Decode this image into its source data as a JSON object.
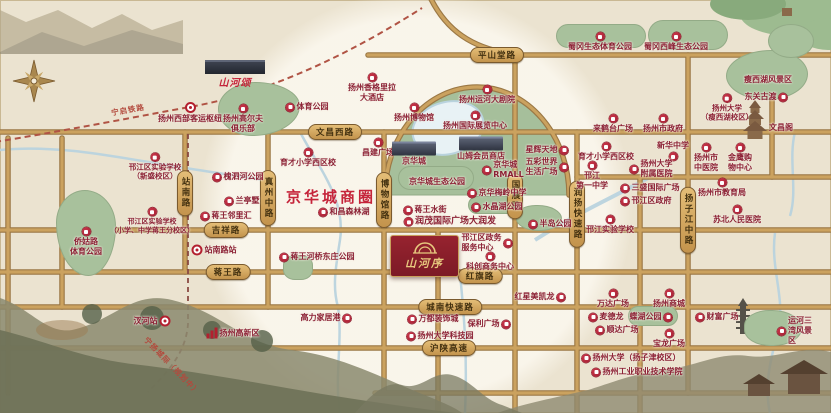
{
  "map": {
    "business_circle": "京华城商圈",
    "project": {
      "name": "山河序",
      "sister_project": "山河颂"
    },
    "colors": {
      "bg": "#ebe3d0",
      "road_fill": "#cba25f",
      "road_edge": "#9b7845",
      "park_green": "#a8c19c",
      "water_blue": "#b9d3de",
      "poi_red": "#9c1e31",
      "poi_text": "#8c2135",
      "pill_gold": "#d4a95f",
      "pill_text": "#42300f",
      "project_red": "#8e1f2f",
      "project_gold": "#e7c87e",
      "accent_red": "#c5243a"
    },
    "road_labels_h": [
      {
        "text": "平山堂路",
        "x": 497,
        "y": 55
      },
      {
        "text": "文昌西路",
        "x": 335,
        "y": 132
      },
      {
        "text": "吉祥路",
        "x": 226,
        "y": 230
      },
      {
        "text": "蒋王路",
        "x": 228,
        "y": 272
      },
      {
        "text": "红旗路",
        "x": 480,
        "y": 276
      },
      {
        "text": "城南快速路",
        "x": 450,
        "y": 307
      },
      {
        "text": "沪陕高速",
        "x": 449,
        "y": 348
      }
    ],
    "road_labels_v": [
      {
        "text": "站南路",
        "x": 185,
        "y": 193
      },
      {
        "text": "真州中路",
        "x": 268,
        "y": 198
      },
      {
        "text": "博物馆路",
        "x": 384,
        "y": 200
      },
      {
        "text": "国展路",
        "x": 515,
        "y": 196
      },
      {
        "text": "润扬快速路",
        "x": 577,
        "y": 214
      },
      {
        "text": "扬子江中路",
        "x": 688,
        "y": 220
      }
    ],
    "rail_labels": [
      {
        "text": "宁启铁路",
        "x": 128,
        "y": 110,
        "angle": -10
      },
      {
        "text": "宁扬城际（规划中）",
        "x": 172,
        "y": 366,
        "angle": 46
      }
    ],
    "pois": [
      {
        "t": "扬州西部客运枢纽",
        "x": 190,
        "y": 113,
        "lay": "col",
        "icon": "station"
      },
      {
        "t": "扬州高尔夫\n俱乐部",
        "x": 243,
        "y": 119,
        "lay": "col",
        "icon": "badge"
      },
      {
        "t": "体育公园",
        "x": 307,
        "y": 107,
        "lay": "row",
        "icon": "badge"
      },
      {
        "t": "扬州香格里拉\n大酒店",
        "x": 372,
        "y": 88,
        "lay": "col",
        "icon": "badge"
      },
      {
        "t": "育才小学西区校",
        "x": 308,
        "y": 158,
        "lay": "col",
        "icon": "badge"
      },
      {
        "t": "昌建广场",
        "x": 378,
        "y": 148,
        "lay": "col",
        "icon": "badge"
      },
      {
        "t": "扬州博物馆",
        "x": 414,
        "y": 113,
        "lay": "col",
        "icon": "badge"
      },
      {
        "t": "扬州运河大剧院",
        "x": 487,
        "y": 95,
        "lay": "col",
        "icon": "badge"
      },
      {
        "t": "扬州国际展览中心",
        "x": 475,
        "y": 121,
        "lay": "col",
        "icon": "badge"
      },
      {
        "t": "蜀冈生态体育公园",
        "x": 600,
        "y": 42,
        "lay": "col",
        "icon": "badge"
      },
      {
        "t": "蜀冈西峰生态公园",
        "x": 676,
        "y": 42,
        "lay": "col",
        "icon": "badge"
      },
      {
        "t": "瘦西湖风景区",
        "x": 768,
        "y": 80,
        "lay": "txt",
        "icon": "none"
      },
      {
        "t": "扬州大学\n（瘦西湖校区）",
        "x": 727,
        "y": 108,
        "lay": "col",
        "icon": "badge",
        "fs": 7.5
      },
      {
        "t": "东关古渡",
        "x": 766,
        "y": 97,
        "lay": "rowr",
        "icon": "badge"
      },
      {
        "t": "文昌阁",
        "x": 781,
        "y": 128,
        "lay": "txt",
        "icon": "none"
      },
      {
        "t": "来鹤台广场",
        "x": 613,
        "y": 124,
        "lay": "col",
        "icon": "badge"
      },
      {
        "t": "扬州市政府",
        "x": 663,
        "y": 124,
        "lay": "col",
        "icon": "badge"
      },
      {
        "t": "新华中学",
        "x": 673,
        "y": 151,
        "lay": "colr",
        "icon": "badge"
      },
      {
        "t": "扬州市\n中医院",
        "x": 706,
        "y": 158,
        "lay": "col",
        "icon": "badge"
      },
      {
        "t": "金鹰购\n物中心",
        "x": 740,
        "y": 158,
        "lay": "col",
        "icon": "badge"
      },
      {
        "t": "扬州市教育局",
        "x": 722,
        "y": 188,
        "lay": "col",
        "icon": "badge"
      },
      {
        "t": "苏北人民医院",
        "x": 737,
        "y": 215,
        "lay": "col",
        "icon": "badge"
      },
      {
        "t": "扬州大学\n附属医院",
        "x": 651,
        "y": 169,
        "lay": "row",
        "icon": "badge"
      },
      {
        "t": "三盛国际广场",
        "x": 650,
        "y": 188,
        "lay": "row",
        "icon": "badge"
      },
      {
        "t": "邗江区政府",
        "x": 646,
        "y": 201,
        "lay": "row",
        "icon": "badge"
      },
      {
        "t": "邗江\n第一中学",
        "x": 592,
        "y": 176,
        "lay": "col",
        "icon": "badge"
      },
      {
        "t": "半岛公园",
        "x": 550,
        "y": 224,
        "lay": "row",
        "icon": "badge"
      },
      {
        "t": "邗江实验学校",
        "x": 610,
        "y": 225,
        "lay": "col",
        "icon": "badge"
      },
      {
        "t": "邗江区实验学校\n（新盛校区）",
        "x": 155,
        "y": 167,
        "lay": "col",
        "icon": "badge",
        "fs": 7.5
      },
      {
        "t": "槐泗河公园",
        "x": 238,
        "y": 177,
        "lay": "row",
        "icon": "badge"
      },
      {
        "t": "兰亭墅",
        "x": 242,
        "y": 201,
        "lay": "row",
        "icon": "badge"
      },
      {
        "t": "蒋王邻里汇",
        "x": 226,
        "y": 216,
        "lay": "row",
        "icon": "badge"
      },
      {
        "t": "邗江区实验学校\n（小学、中学蒋王分校区）",
        "x": 152,
        "y": 221,
        "lay": "col",
        "icon": "badge",
        "fs": 7
      },
      {
        "t": "侨姑路\n体育公园",
        "x": 86,
        "y": 242,
        "lay": "col",
        "icon": "badge"
      },
      {
        "t": "站南路站",
        "x": 214,
        "y": 250,
        "lay": "row",
        "icon": "station"
      },
      {
        "t": "京华城",
        "x": 414,
        "y": 154,
        "lay": "col",
        "icon": "bldg"
      },
      {
        "t": "山姆会员商店",
        "x": 481,
        "y": 149,
        "lay": "col",
        "icon": "bldg"
      },
      {
        "t": "京华城\nRMALL",
        "x": 503,
        "y": 170,
        "lay": "row",
        "icon": "badge"
      },
      {
        "t": "京华城生态公园",
        "x": 437,
        "y": 182,
        "lay": "txt",
        "icon": "none"
      },
      {
        "t": "京华梅岭中学",
        "x": 497,
        "y": 193,
        "lay": "row",
        "icon": "badge"
      },
      {
        "t": "水晶湖公园",
        "x": 497,
        "y": 207,
        "lay": "row",
        "icon": "badge"
      },
      {
        "t": "蒋王水街",
        "x": 425,
        "y": 210,
        "lay": "row",
        "icon": "badge"
      },
      {
        "t": "润茂国际广场大润发",
        "x": 450,
        "y": 222,
        "lay": "row",
        "icon": "badge",
        "fs": 9
      },
      {
        "t": "和昌森林湖",
        "x": 344,
        "y": 212,
        "lay": "row",
        "icon": "badge"
      },
      {
        "t": "星辉天地",
        "x": 547,
        "y": 150,
        "lay": "rowr",
        "icon": "badge"
      },
      {
        "t": "五彩世界\n生活广场",
        "x": 547,
        "y": 167,
        "lay": "rowr",
        "icon": "badge"
      },
      {
        "t": "育才小学西区校",
        "x": 606,
        "y": 152,
        "lay": "col",
        "icon": "badge"
      },
      {
        "t": "蒋王河桥东庄公园",
        "x": 317,
        "y": 257,
        "lay": "row",
        "icon": "badge"
      },
      {
        "t": "邗江区政务\n服务中心",
        "x": 487,
        "y": 243,
        "lay": "rowr",
        "icon": "badge"
      },
      {
        "t": "科创商务中心",
        "x": 490,
        "y": 262,
        "lay": "col",
        "icon": "badge"
      },
      {
        "t": "红星美凯龙",
        "x": 540,
        "y": 297,
        "lay": "rowr",
        "icon": "badge"
      },
      {
        "t": "万都装饰城",
        "x": 433,
        "y": 319,
        "lay": "row",
        "icon": "badge"
      },
      {
        "t": "保利广场",
        "x": 489,
        "y": 324,
        "lay": "rowr",
        "icon": "badge"
      },
      {
        "t": "扬州大学科技园",
        "x": 440,
        "y": 336,
        "lay": "row",
        "icon": "badge"
      },
      {
        "t": "万达广场",
        "x": 613,
        "y": 299,
        "lay": "col",
        "icon": "badge"
      },
      {
        "t": "扬州商城",
        "x": 669,
        "y": 299,
        "lay": "col",
        "icon": "badge"
      },
      {
        "t": "麦德龙",
        "x": 606,
        "y": 317,
        "lay": "row",
        "icon": "badge"
      },
      {
        "t": "蝶湖公园",
        "x": 651,
        "y": 317,
        "lay": "rowr",
        "icon": "badge"
      },
      {
        "t": "顺达广场",
        "x": 617,
        "y": 330,
        "lay": "row",
        "icon": "badge"
      },
      {
        "t": "宝龙广场",
        "x": 669,
        "y": 339,
        "lay": "col",
        "icon": "badge"
      },
      {
        "t": "财富广场",
        "x": 717,
        "y": 317,
        "lay": "row",
        "icon": "badge"
      },
      {
        "t": "运河三湾风景区",
        "x": 795,
        "y": 331,
        "lay": "row",
        "icon": "badge"
      },
      {
        "t": "扬州大学（扬子津校区）",
        "x": 631,
        "y": 358,
        "lay": "row",
        "icon": "badge"
      },
      {
        "t": "扬州工业职业技术学院",
        "x": 637,
        "y": 372,
        "lay": "row",
        "icon": "badge"
      },
      {
        "t": "汊河站",
        "x": 152,
        "y": 321,
        "lay": "rowr",
        "icon": "station"
      },
      {
        "t": "扬州高新区",
        "x": 233,
        "y": 333,
        "lay": "row",
        "icon": "hq"
      },
      {
        "t": "高力家居港",
        "x": 326,
        "y": 318,
        "lay": "rowr",
        "icon": "badge"
      }
    ],
    "parks": [
      {
        "x": 218,
        "y": 82,
        "w": 80,
        "h": 52,
        "r": "46% 54% 58% 42% / 50% 44% 56% 50%"
      },
      {
        "x": 56,
        "y": 190,
        "w": 58,
        "h": 84,
        "r": "48% 52% 46% 54% / 38% 42% 58% 62%"
      },
      {
        "x": 556,
        "y": 24,
        "w": 88,
        "h": 22,
        "r": "40px"
      },
      {
        "x": 648,
        "y": 20,
        "w": 78,
        "h": 28,
        "r": "40px"
      },
      {
        "x": 726,
        "y": 50,
        "w": 80,
        "h": 48,
        "r": "55% 45% 50% 50% / 52% 48% 52% 48%"
      },
      {
        "x": 768,
        "y": 24,
        "w": 44,
        "h": 32,
        "r": "50%"
      },
      {
        "x": 398,
        "y": 166,
        "w": 74,
        "h": 22,
        "r": "20px"
      },
      {
        "x": 468,
        "y": 196,
        "w": 46,
        "h": 16,
        "r": "14px"
      },
      {
        "x": 516,
        "y": 205,
        "w": 44,
        "h": 24,
        "r": "45% 55% 50% 50%"
      },
      {
        "x": 628,
        "y": 306,
        "w": 48,
        "h": 18,
        "r": "16px"
      },
      {
        "x": 744,
        "y": 310,
        "w": 56,
        "h": 34,
        "r": "46% 54% 52% 48%"
      },
      {
        "x": 283,
        "y": 255,
        "w": 28,
        "h": 23,
        "r": "40%"
      }
    ]
  }
}
